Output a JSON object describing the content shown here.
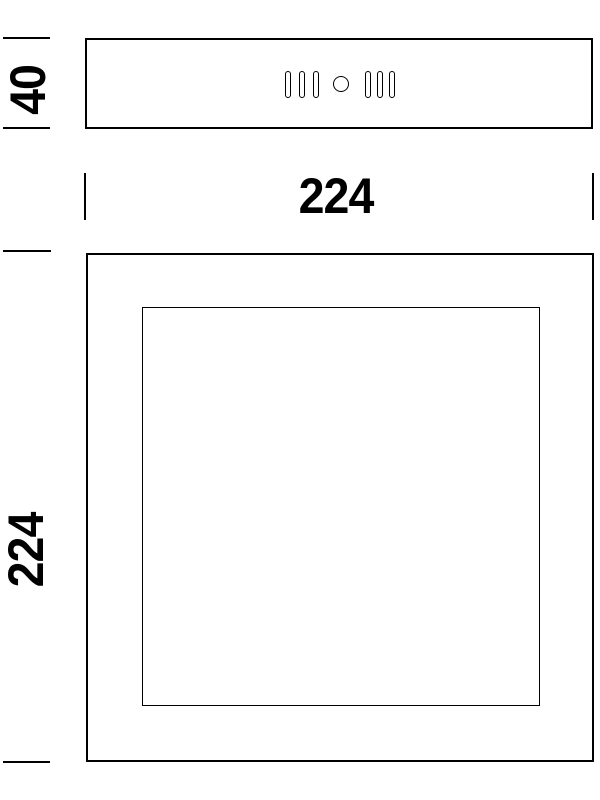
{
  "drawing": {
    "type": "technical-dimension-drawing",
    "background_color": "#ffffff",
    "line_color": "#000000",
    "dimensions": {
      "side_height": "40",
      "width": "224",
      "front_height": "224"
    },
    "side_view": {
      "description": "side profile of fixture housing",
      "vent_slots_left": 3,
      "vent_slots_right": 3,
      "center_hole": 1
    },
    "front_view": {
      "description": "front face with inset panel"
    }
  }
}
